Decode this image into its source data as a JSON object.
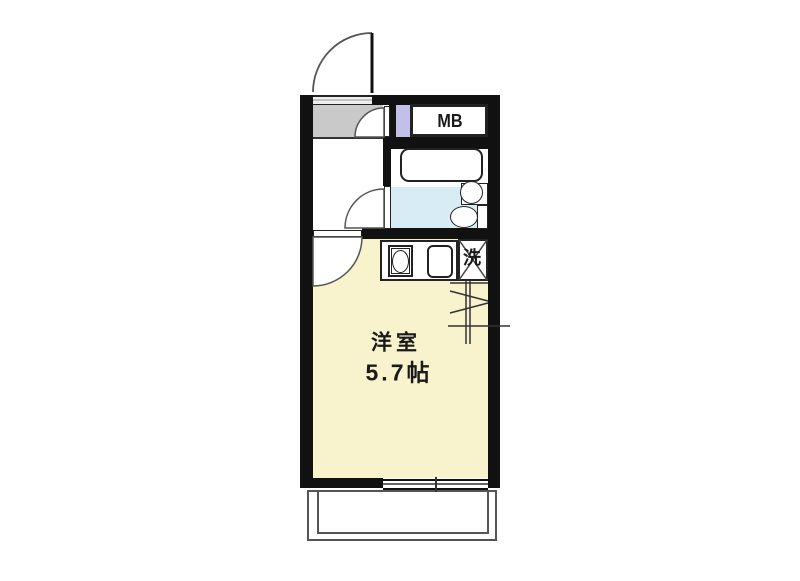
{
  "plan": {
    "labels": {
      "room_name": "洋室",
      "room_size": "5.7帖",
      "meter_box": "MB",
      "laundry": "洗"
    },
    "colors": {
      "wall": "#111111",
      "room_fill": "#F8F2CD",
      "bathroom_floor": "#D7ECF5",
      "entrance_floor": "#C9C9C9",
      "pipe_space": "#C2C0E8",
      "line": "#555555"
    }
  }
}
